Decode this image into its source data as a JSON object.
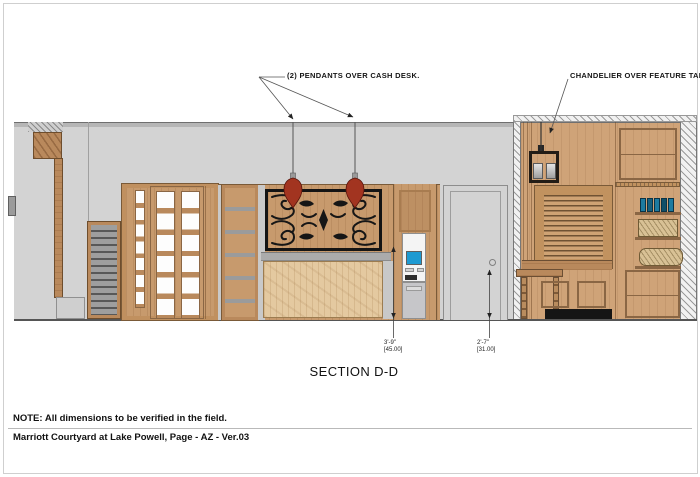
{
  "sheet": {
    "title": "SECTION D-D",
    "note": "NOTE: All dimensions to be verified in the field.",
    "project_line": "Marriott Courtyard at Lake Powell, Page - AZ - Ver.03"
  },
  "callouts": {
    "pendants_label": "(2) PENDANTS OVER CASH DESK.",
    "chandelier_label": "CHANDELIER OVER FEATURE TABLE."
  },
  "dimensions": [
    {
      "feet_inches": "3'-9\"",
      "decimal": "[45.00]"
    },
    {
      "feet_inches": "2'-7\"",
      "decimal": "[31.00]"
    }
  ],
  "colors": {
    "wall_gray": "#d3d3d3",
    "wood_mid": "#c79a6d",
    "wood_desk_pine": "#e4c9a0",
    "wood_right": "#cfa378",
    "pendant_red": "#a23420",
    "atm_screen_blue": "#1d9ad2",
    "book_teal": "#1d7ba0",
    "ironwork_black": "#161616"
  }
}
